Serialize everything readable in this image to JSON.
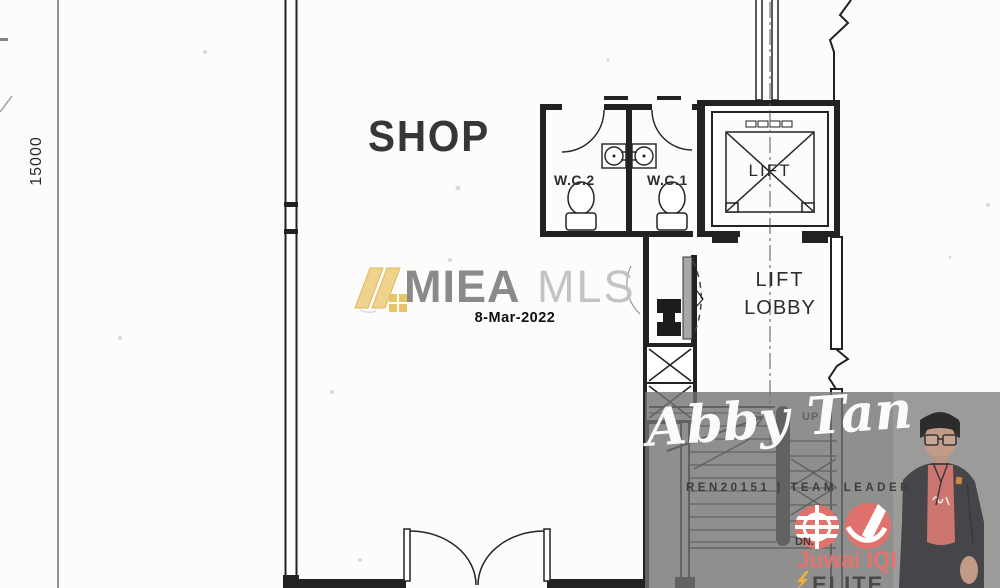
{
  "floor_plan": {
    "dimension_left": "15000",
    "shop_label": "SHOP",
    "wc2_label": "W.C.2",
    "wc1_label": "W.C.1",
    "lift_label": "LIFT",
    "lobby_line1": "LIFT",
    "lobby_line2": "LOBBY",
    "up_label": "UP",
    "line_color": "#222222"
  },
  "watermark_center": {
    "brand_bold": "MIEA",
    "brand_light": "MLS",
    "date": "8-Mar-2022",
    "slash_color": "#efd28c",
    "brand_bold_color": "#8a8a8a",
    "brand_light_color": "#c3c3c3",
    "date_color": "#101010"
  },
  "watermark_agent": {
    "name": "Abby Tan",
    "credentials": "REN20151 | TEAM LEADER",
    "dn_label": "DN.",
    "brand": "Juwai IQI",
    "tier": "ELITE",
    "band_color": "#737373",
    "logo_red": "#e0716c",
    "bolt_color": "#ecb43d",
    "tier_color": "#4a4a4a"
  }
}
